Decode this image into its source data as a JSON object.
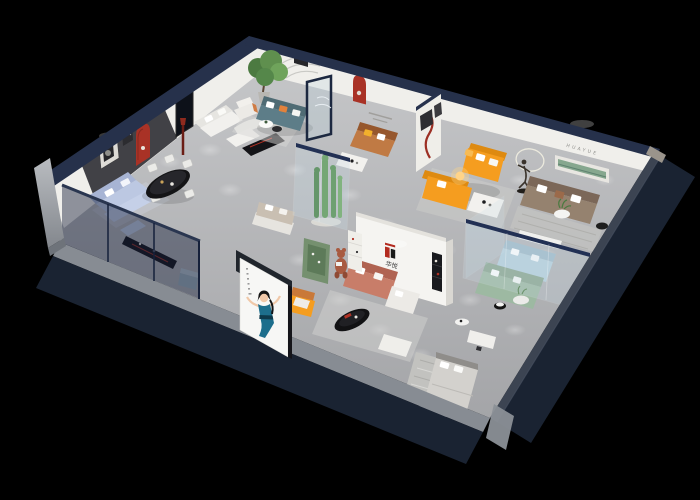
{
  "meta": {
    "description": "3D isometric cutaway render of a HUAYUE furniture showroom floor plan on a black background",
    "canvas_width": 700,
    "canvas_height": 500
  },
  "brand": {
    "logo_mark": "H",
    "logo_cn": "华悦",
    "wall_letters": "HUAYUE"
  },
  "colors": {
    "background": "#000000",
    "floor_light": "#c7c8ca",
    "floor_dark": "#a4a5a8",
    "wall_navy": "#1a2332",
    "wall_navy_top": "#26314b",
    "wall_ledge": "#878c93",
    "wall_white": "#f0efeb",
    "feature_wall": "#414146",
    "arch_red": "#a93226",
    "decor_red": "#9c2f24",
    "sofa_periwinkle": "#bcc8e2",
    "sofa_teal": "#5d7d88",
    "sofa_caramel": "#c07a44",
    "sofa_orange": "#f59d1f",
    "sofa_brown": "#95826f",
    "sofa_coral": "#c87d69",
    "sofa_lightblue": "#b6cfdc",
    "sofa_sage": "#9db9a2",
    "sofa_taupe": "#c9bfb2",
    "pillow_orange": "#e2823c",
    "pillow_yellow": "#f2b02c",
    "shelf_green": "#86a78e",
    "cabinet_green": "#75906f",
    "plant_green": "#4c7a41",
    "glass_frame": "#223054",
    "table_black": "#121214",
    "table_white": "#f2f1ee",
    "bed_gray": "#d3d1cd",
    "billboard_white": "#f7f7f5",
    "dress_teal": "#1d6e8c",
    "logo_red": "#b32b20",
    "logo_black": "#1a1a1a",
    "teddy_brown": "#a85a40",
    "glow_warm": "#ffd488",
    "sculpture_dark": "#3a332c"
  },
  "objects": [
    "periwinkle fabric sectional sofa",
    "black oval dining table with white chairs",
    "red arched wall niches",
    "dark feature wall with artwork",
    "white modular sofa and coffee table",
    "black media console",
    "teal three-seat sofa with orange pillows",
    "potted indoor tree",
    "white accent armchair",
    "glass entry partition",
    "caramel leather sofa",
    "orange L-shaped sectional with lit lamp",
    "running-figure sculpture with light ring",
    "brown fabric sofa",
    "green recessed display shelf",
    "glass atrium with cacti",
    "brand logo wall",
    "coral sectional sofa with white chaise",
    "black oval coffee table",
    "white ottoman",
    "light blue sofa",
    "sage green sofa",
    "round side tables with plants",
    "upholstered gray bed with striped rug",
    "white desk",
    "advertising board with illustrated woman in blue dress",
    "green display cabinet",
    "teddy bear sculpture",
    "orange leather armchair",
    "gray cube ottoman"
  ]
}
